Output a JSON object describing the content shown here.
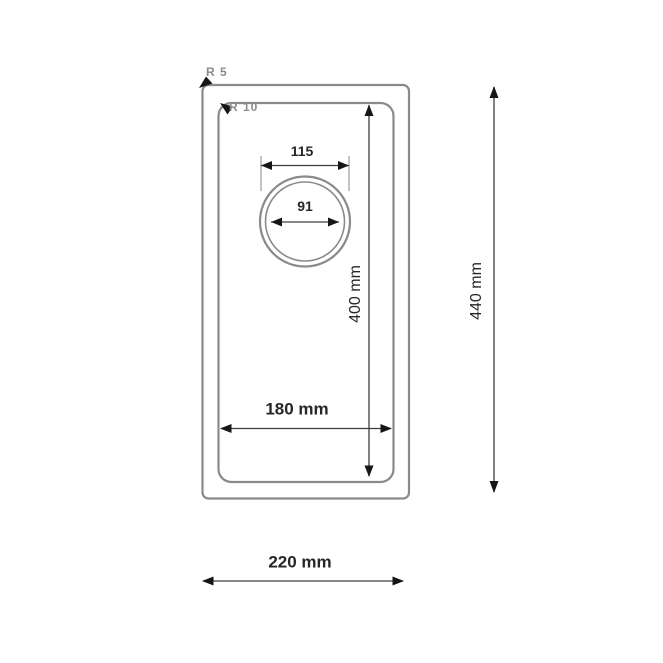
{
  "drawing": {
    "callouts": {
      "r5": "R 5",
      "r10": "R 10"
    },
    "dimensions": {
      "drain_rim_diameter": "115",
      "drain_hole_diameter": "91",
      "bowl_length": "400 mm",
      "overall_length": "440 mm",
      "bowl_width": "180 mm",
      "overall_width": "220 mm"
    },
    "colors": {
      "outline": "#8a8a8a",
      "dimension_line": "#3d3d3d",
      "arrow": "#161616",
      "text": "#262626",
      "callout_text": "#8c8c8c",
      "background": "#ffffff"
    }
  }
}
